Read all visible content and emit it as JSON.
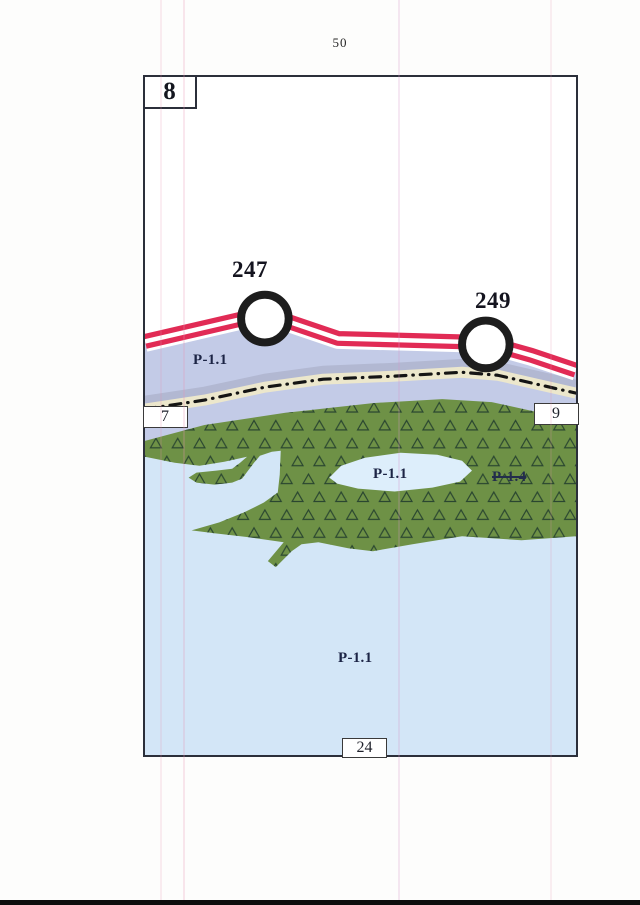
{
  "page_number": "50",
  "sheet_label": "8",
  "markers": [
    {
      "label": "247"
    },
    {
      "label": "249"
    }
  ],
  "zone_labels": {
    "band": "P-1.1",
    "island": "P-1.1",
    "struck": "P-1.4",
    "water": "P-1.1"
  },
  "adjacent_sheet_refs": {
    "left": "7",
    "right": "9",
    "bottom": "24"
  },
  "colors": {
    "road_stripe": "#e12b55",
    "band_lavender": "#c3cbe7",
    "band_gray": "#b2b8d2",
    "band_cream": "#ece7cc",
    "boundary_line": "#141414",
    "green_area": "#6e9146",
    "triangle_outline": "#2a4630",
    "water": "#d3e6f7",
    "island": "#ddeefb",
    "marker_ring": "#1d1d1d"
  }
}
